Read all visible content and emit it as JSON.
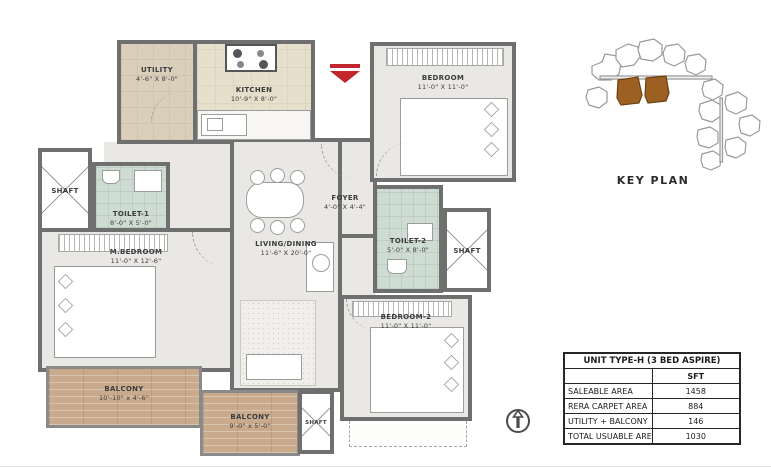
{
  "plan": {
    "rooms": {
      "utility": {
        "name": "UTILITY",
        "dims": "4'-6\" X 8'-0\""
      },
      "kitchen": {
        "name": "KITCHEN",
        "dims": "10'-9\" X 8'-0\""
      },
      "foyer": {
        "name": "FOYER",
        "dims": "4'-0\" X 4'-4\""
      },
      "bedroom": {
        "name": "BEDROOM",
        "dims": "11'-0\" X 11'-0\""
      },
      "shaft_left": {
        "name": "SHAFT"
      },
      "toilet1": {
        "name": "TOILET-1",
        "dims": "8'-0\" X 5'-0\""
      },
      "mbedroom": {
        "name": "M.BEDROOM",
        "dims": "11'-0\" X 12'-6\""
      },
      "living": {
        "name": "LIVING/DINING",
        "dims": "11'-6\" X 20'-0\""
      },
      "toilet2": {
        "name": "TOILET-2",
        "dims": "5'-0\" X 8'-0\""
      },
      "shaft_right": {
        "name": "SHAFT"
      },
      "bedroom2": {
        "name": "BEDROOM-2",
        "dims": "11'-0\" X 11'-0\""
      },
      "balcony1": {
        "name": "BALCONY",
        "dims": "10'-10\" x 4'-6\""
      },
      "balcony2": {
        "name": "BALCONY",
        "dims": "9'-0\" x 5'-0\""
      },
      "shaft_bottom": {
        "name": "SHAFT"
      }
    },
    "colors": {
      "wall": "#6f6f6f",
      "entry_arrow": "#c1272d",
      "tile_green": "#cfdcd3",
      "kitchen_beige": "#e6dfcc",
      "balcony_wood": "#c9aa8c"
    }
  },
  "key_plan": {
    "label": "KEY PLAN",
    "highlight_color": "#9c6122"
  },
  "area_table": {
    "title": "UNIT TYPE-H (3 BED ASPIRE)",
    "unit_header": "SFT",
    "rows": [
      {
        "label": "SALEABLE AREA",
        "value": "1458"
      },
      {
        "label": "RERA CARPET AREA",
        "value": "884"
      },
      {
        "label": "UTILITY + BALCONY",
        "value": "146"
      },
      {
        "label": "TOTAL USUABLE AREA (B+C)",
        "value": "1030"
      }
    ]
  }
}
